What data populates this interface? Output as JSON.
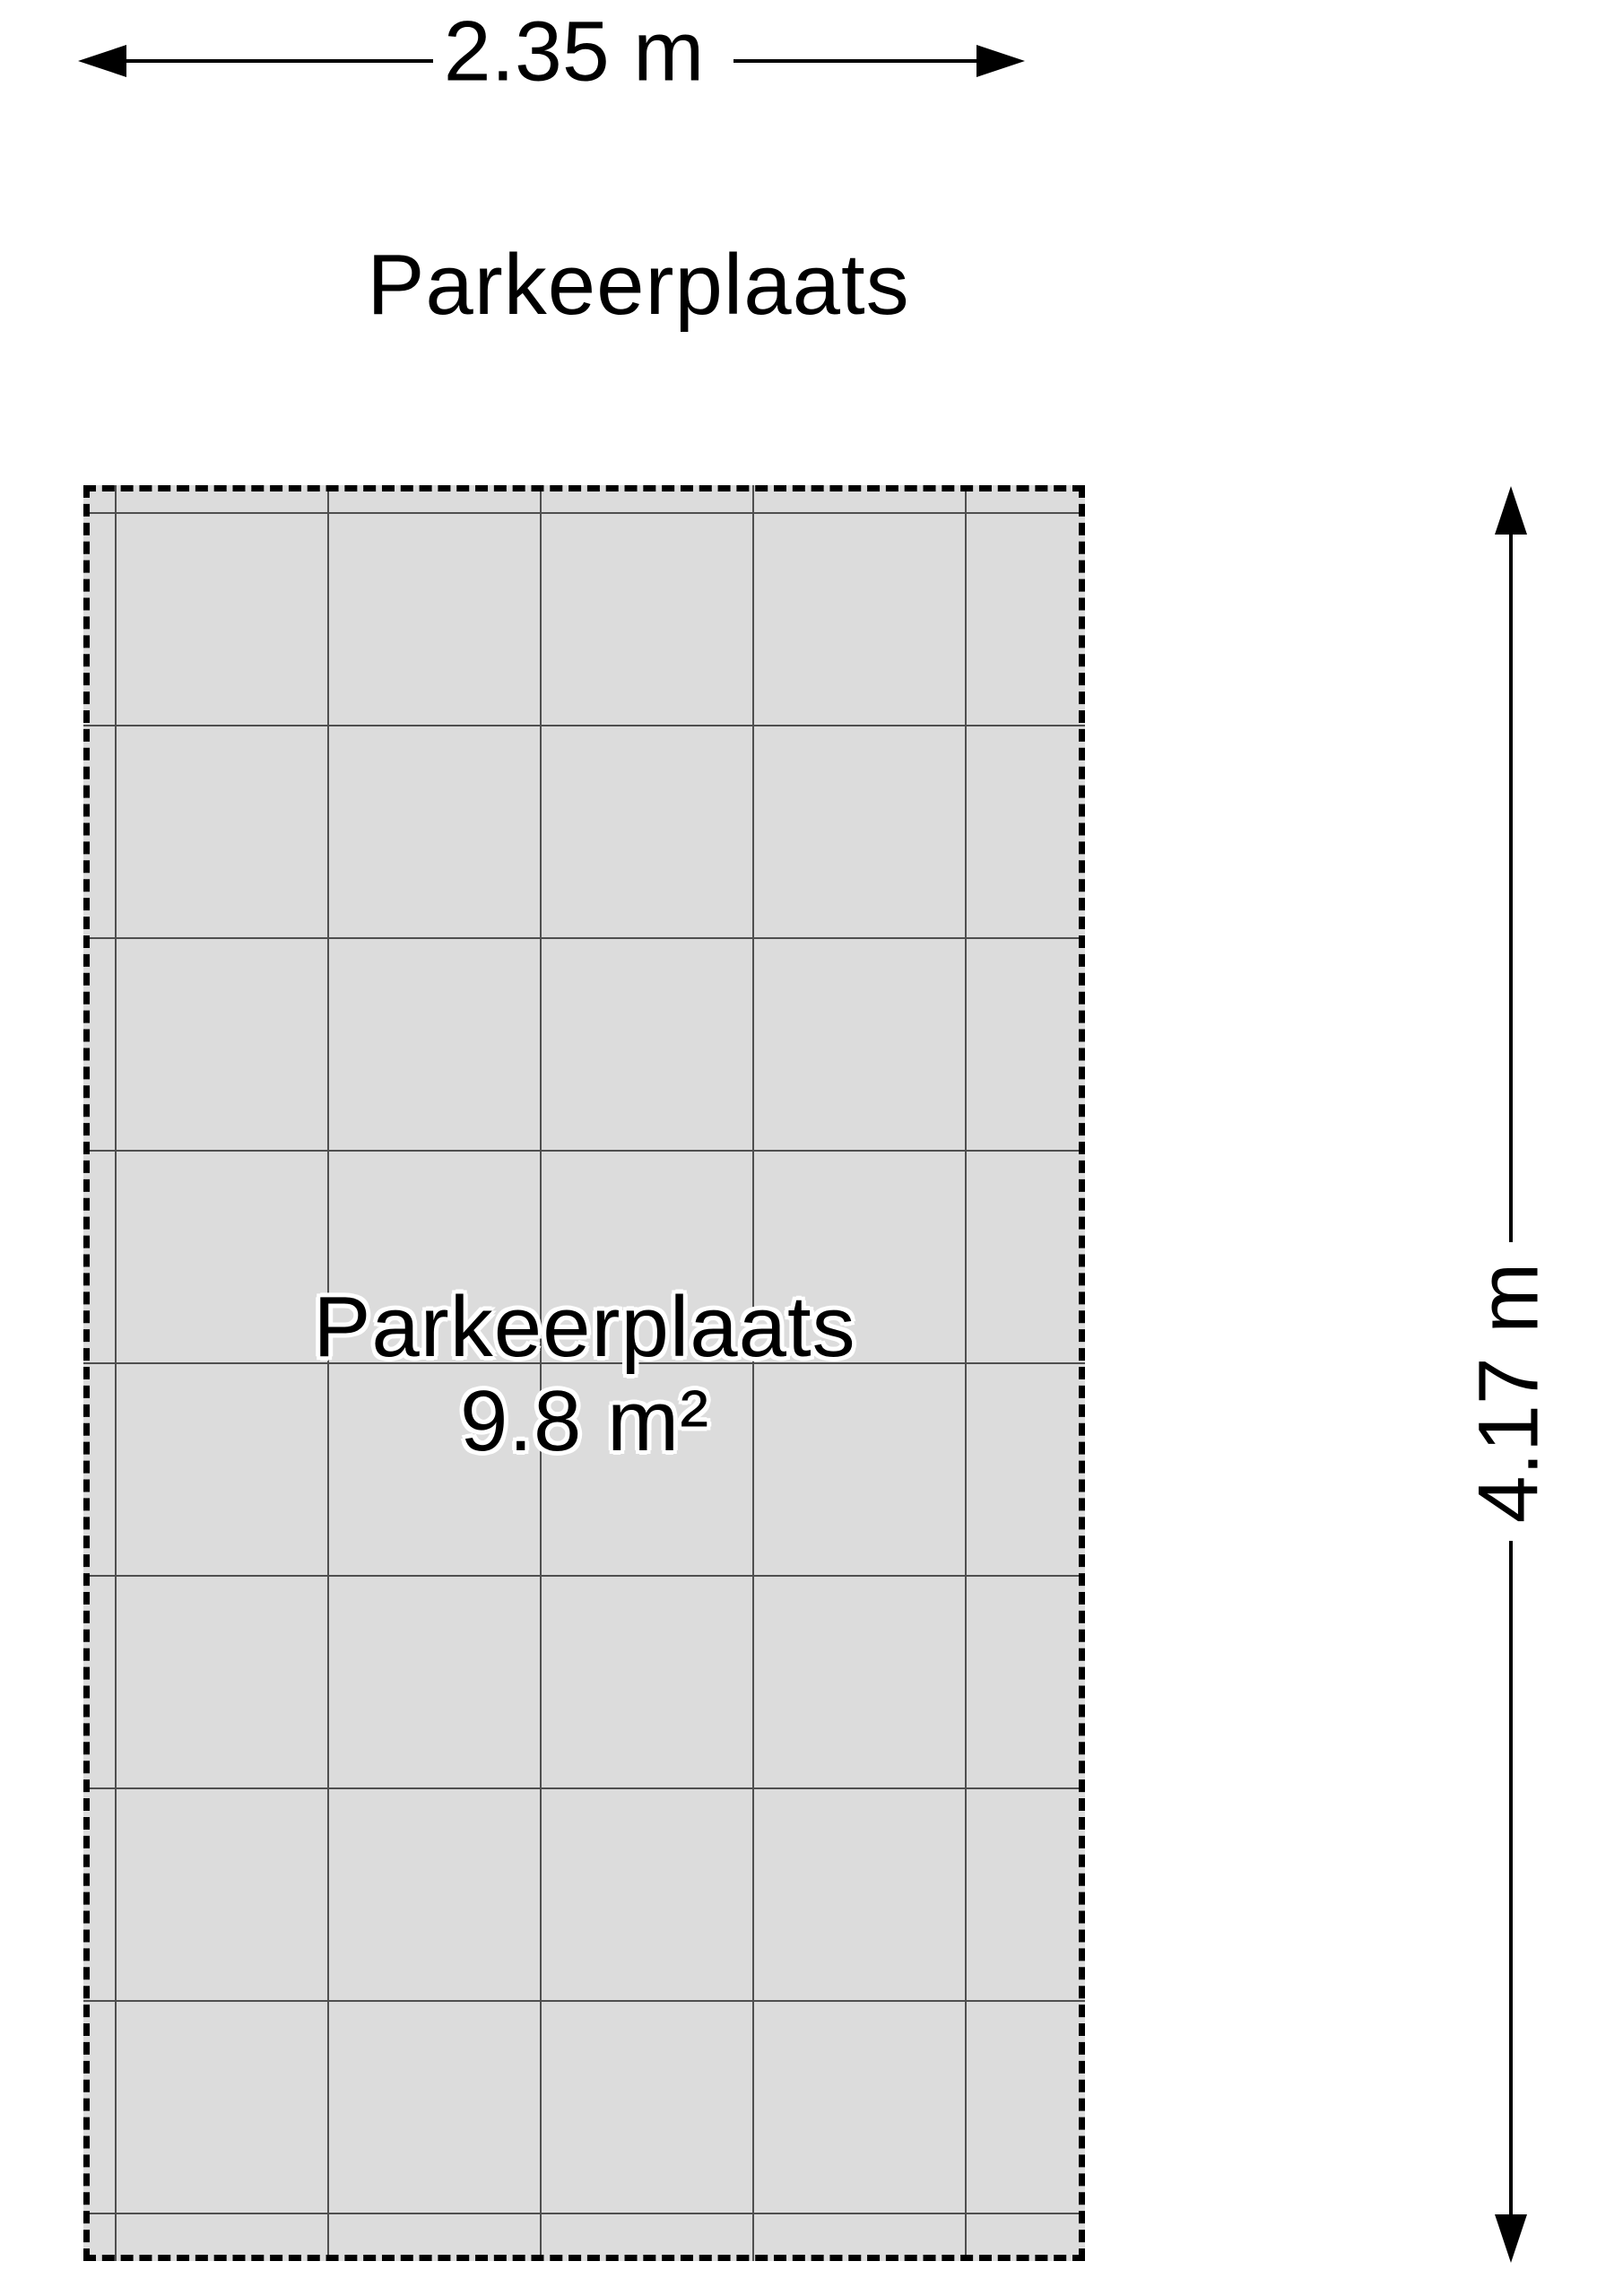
{
  "diagram": {
    "title": "Parkeerplaats",
    "room": {
      "name": "Parkeerplaats",
      "area_label": "9.8 m²"
    },
    "dimensions": {
      "width_label": "2.35 m",
      "height_label": "4.17 m"
    },
    "grid": {
      "cell_meters": 0.5
    },
    "colors": {
      "floor_fill": "#dcdcdc",
      "grid_line": "#4f4f4f",
      "outline": "#000000",
      "label_text": "#000000",
      "label_halo": "#ffffff"
    }
  }
}
